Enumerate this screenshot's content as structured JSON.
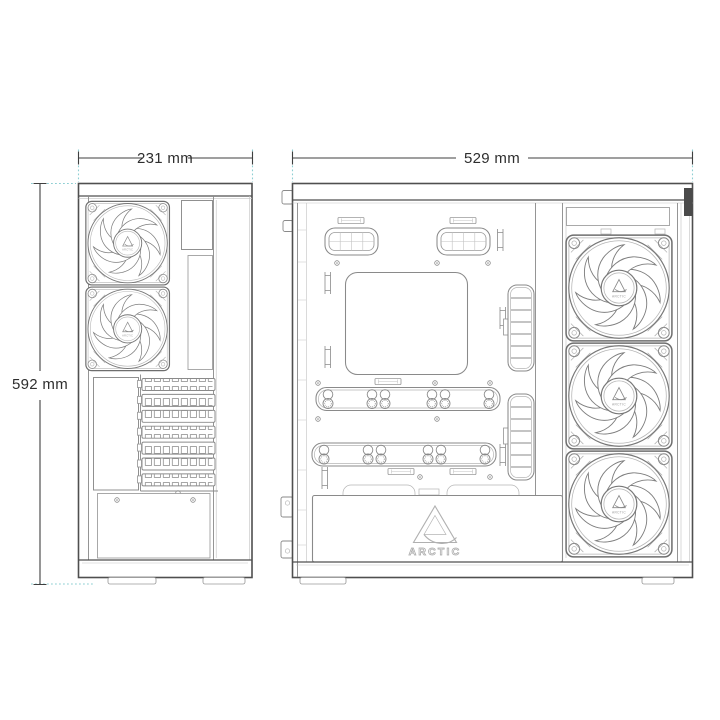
{
  "title": "ARCTIC PC case technical dimension drawing",
  "brand": "ARCTIC",
  "dimensions": {
    "rear_width": "231 mm",
    "side_width": "529 mm",
    "height": "592 mm"
  },
  "icons": {
    "fan": "arctic-p12-fan",
    "brand_logo": "arctic-triangle"
  },
  "colors": {
    "background": "#ffffff",
    "outline": "#4f4f4f",
    "detail_line": "#8a8a8a",
    "light_line": "#c2c2c2",
    "dimension_line": "#3f3f3f",
    "extension_line": "#8ecfd3",
    "label_text": "#2e2e2e",
    "corner_accent": "#4a4a4a"
  }
}
